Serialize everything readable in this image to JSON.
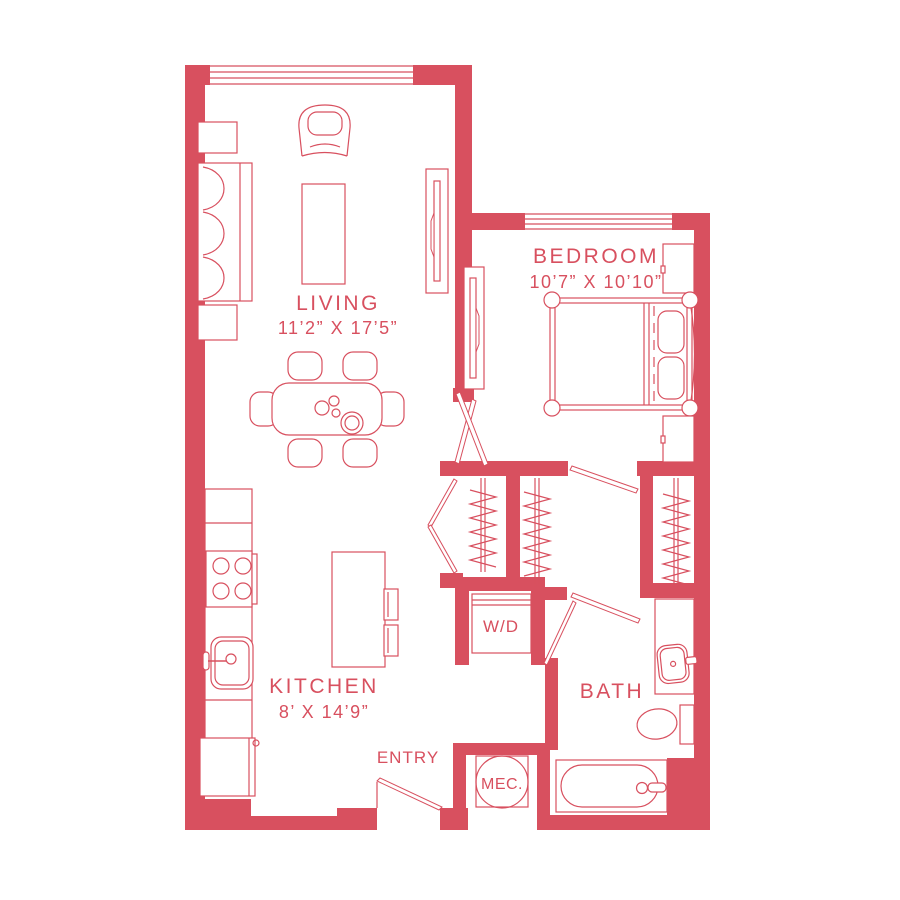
{
  "accent": "#D8505F",
  "background": "#FFFFFF",
  "plan": {
    "type": "apartment-floor-plan",
    "rooms": {
      "living": {
        "name": "LIVING",
        "dims": "11’2” X 17’5”"
      },
      "bedroom": {
        "name": "BEDROOM",
        "dims": "10’7” X 10’10”"
      },
      "kitchen": {
        "name": "KITCHEN",
        "dims": "8’ X 14’9”"
      },
      "bath": {
        "name": "BATH"
      },
      "entry": {
        "name": "ENTRY"
      },
      "laundry": {
        "name": "W/D"
      },
      "mechanical": {
        "name": "MEC."
      }
    }
  }
}
